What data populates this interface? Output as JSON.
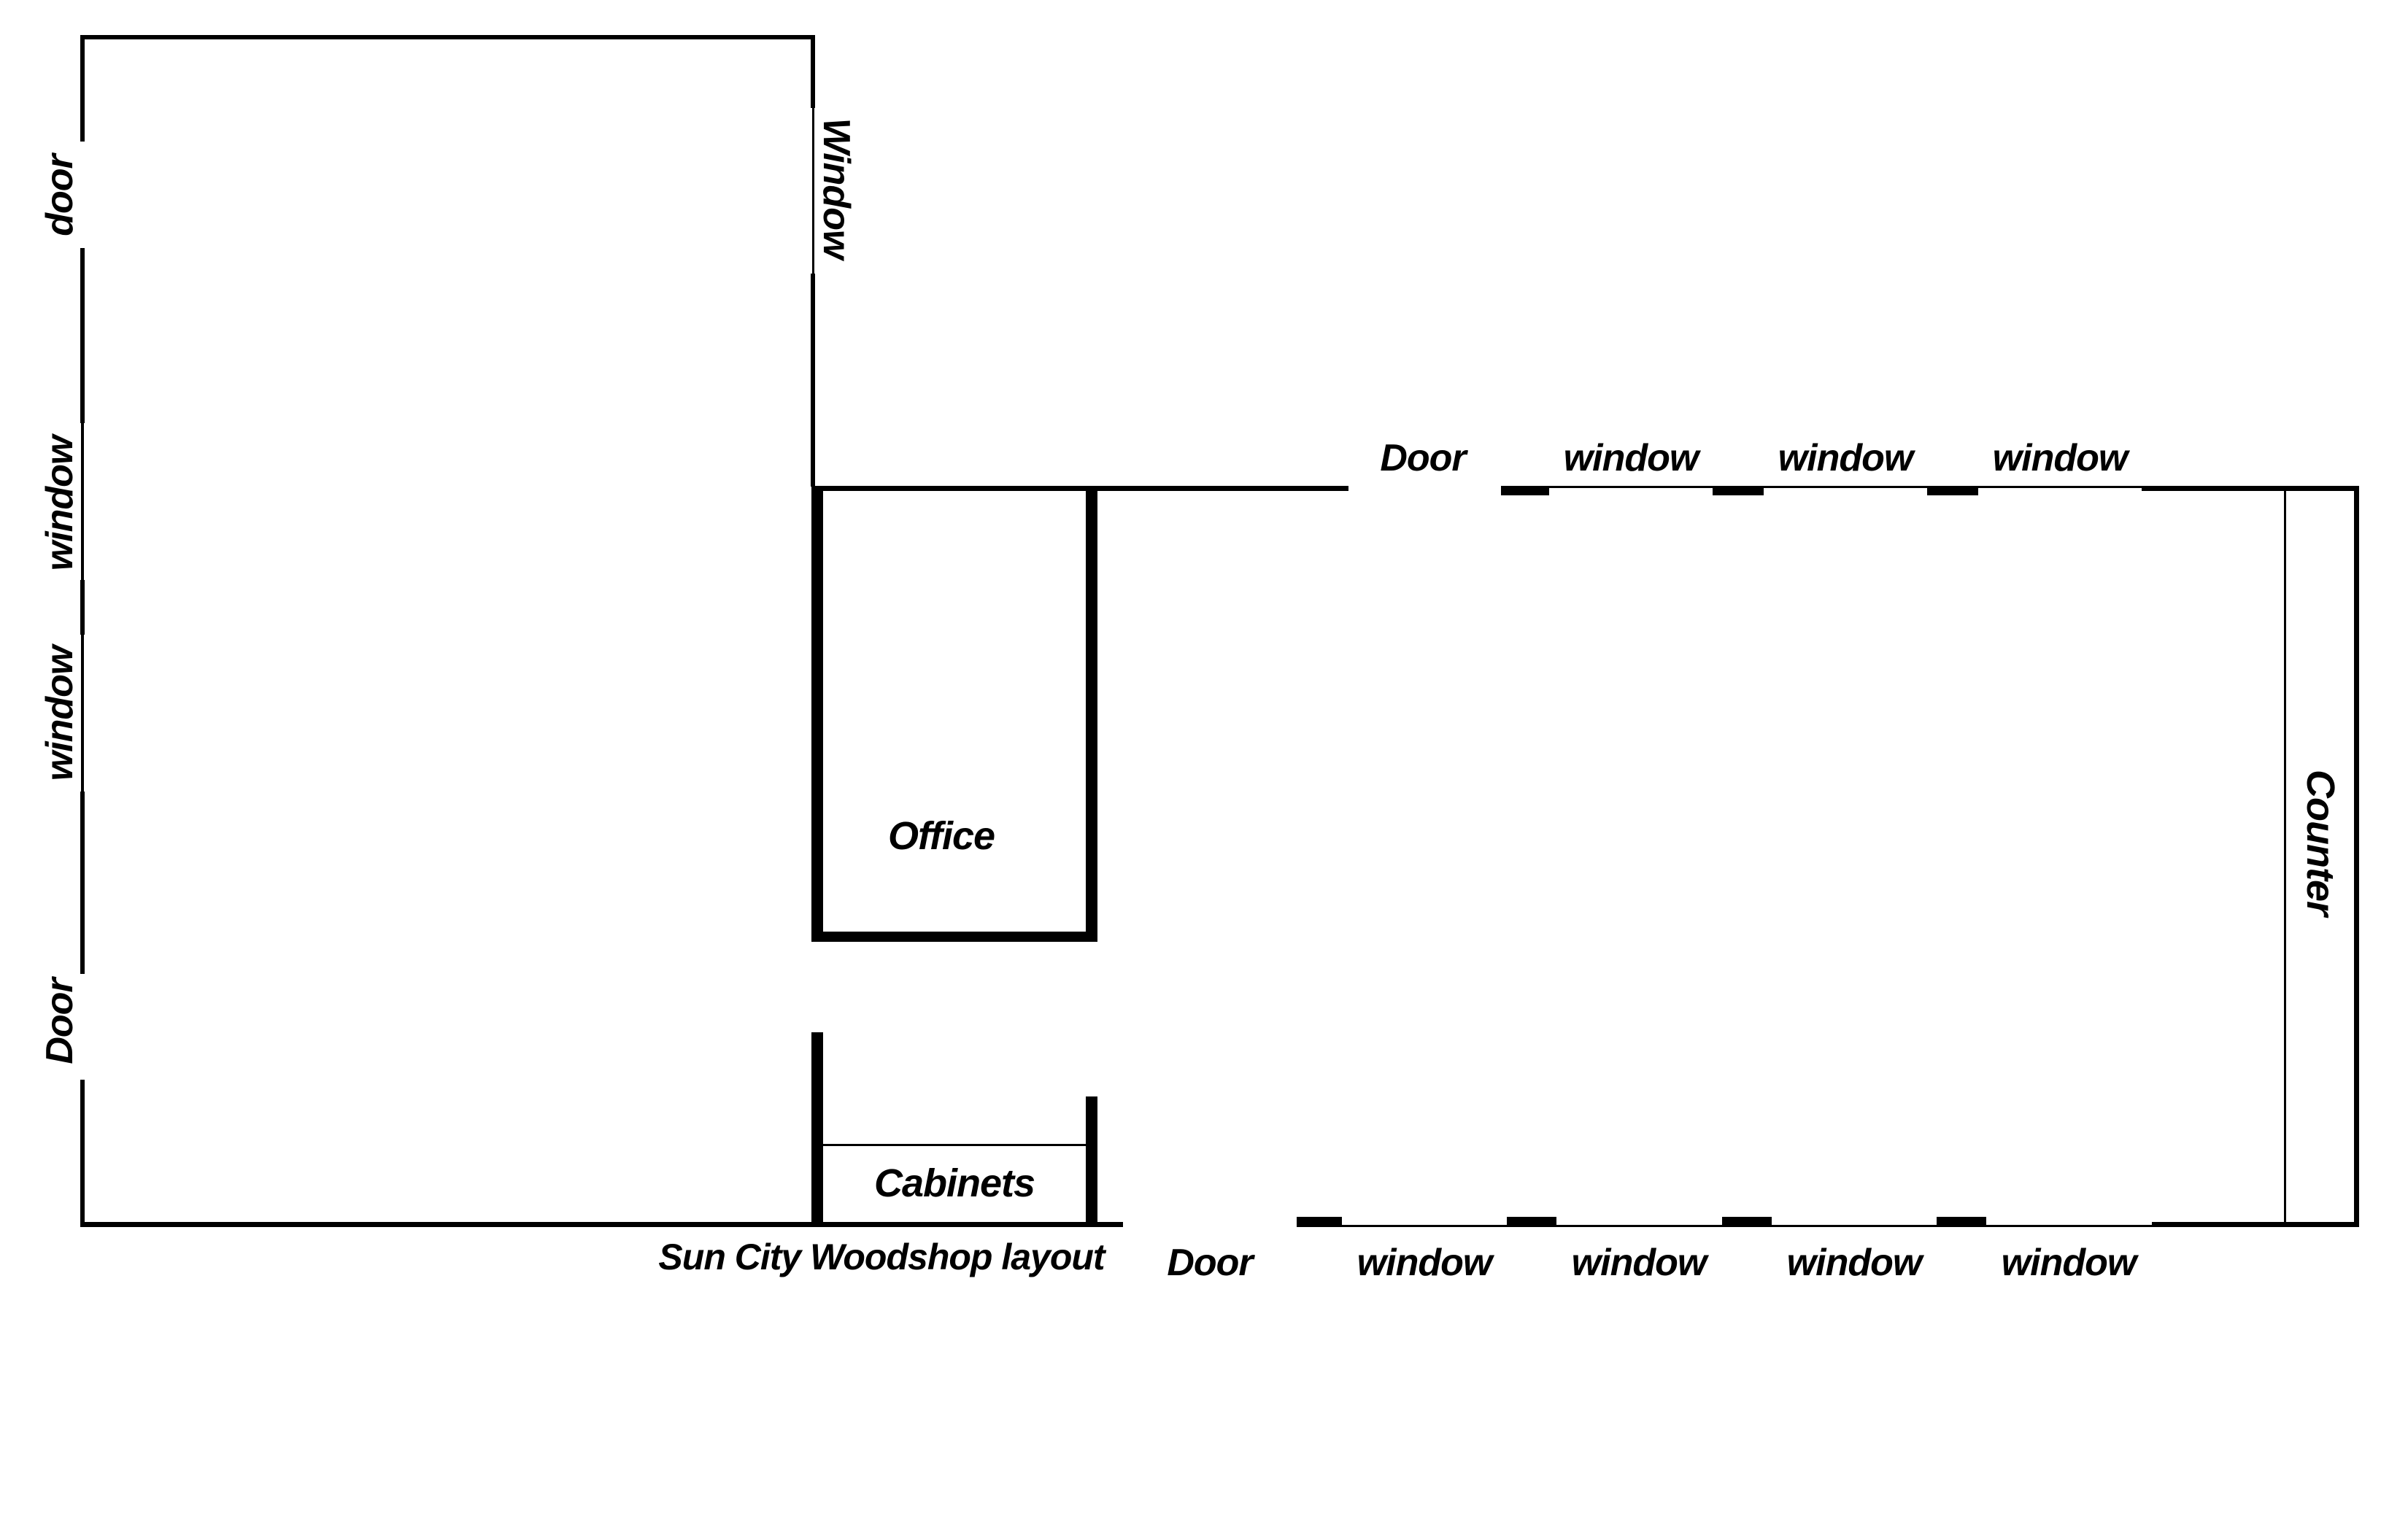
{
  "title": "Sun City Woodshop layout",
  "colors": {
    "wall": "#000000",
    "text": "#000000",
    "background": "#ffffff"
  },
  "rooms": {
    "office": "Office",
    "cabinets": "Cabinets",
    "counter": "Counter"
  },
  "left_wall": {
    "door_top": "door",
    "window_1": "window",
    "window_2": "window",
    "door_bottom": "Door"
  },
  "divider_wall": {
    "window": "Window"
  },
  "shop_top_wall": {
    "door": "Door",
    "window_1": "window",
    "window_2": "window",
    "window_3": "window"
  },
  "shop_bottom_wall": {
    "door": "Door",
    "window_1": "window",
    "window_2": "window",
    "window_3": "window",
    "window_4": "window"
  }
}
